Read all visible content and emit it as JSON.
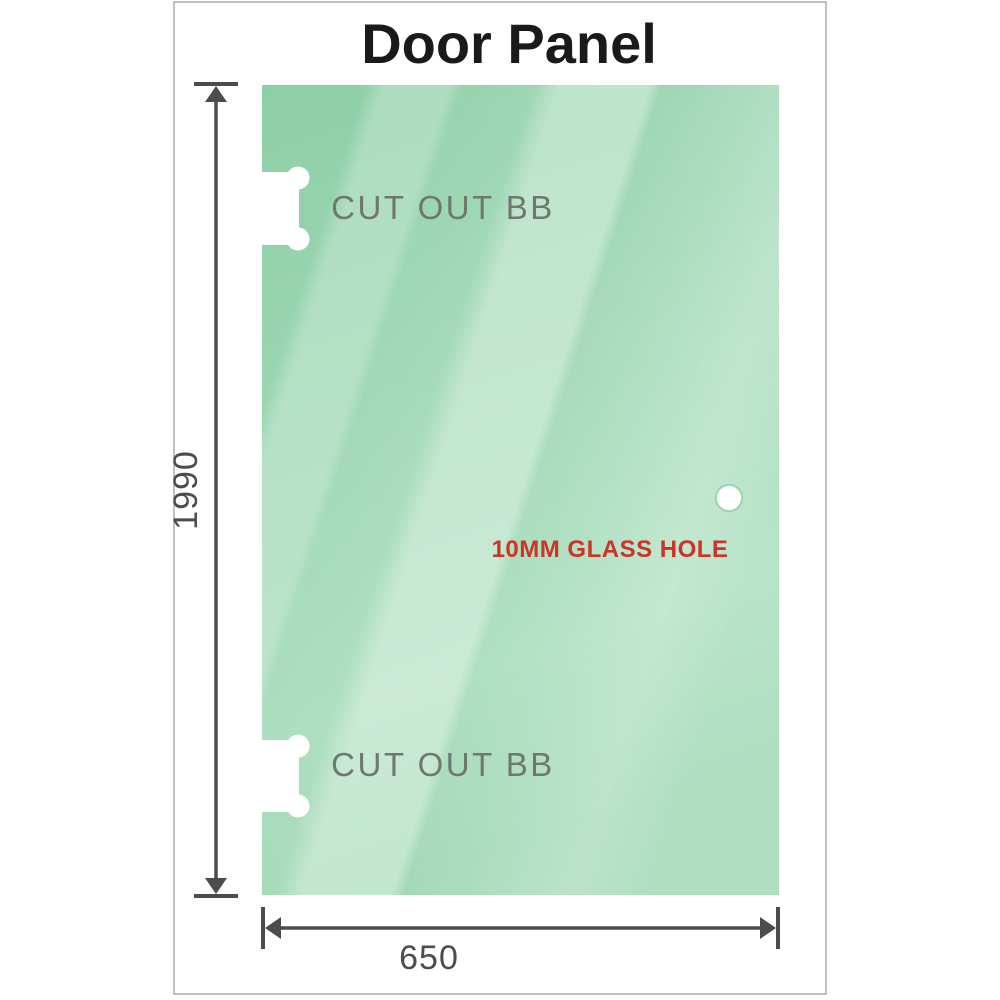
{
  "diagram": {
    "title": "Door Panel",
    "panel": {
      "cutout_top_label": "CUT OUT BB",
      "cutout_bottom_label": "CUT OUT BB",
      "hole_label": "10MM GLASS HOLE"
    },
    "dimensions": {
      "height_value": "1990",
      "width_value": "650"
    },
    "colors": {
      "glass_top": "#8ecfa7",
      "glass_mid": "#9dd7b3",
      "glass_mid2": "#a6dcba",
      "glass_bottom": "#9ad5b0",
      "frame_border": "#ababab",
      "title_color": "#1a1a1a",
      "label_gray": "#6e786f",
      "hole_label_red": "#cc3526",
      "dimension_gray": "#4c4c4c",
      "hole_ring_green": "#7cc49c",
      "hole_fill": "#ffffff",
      "cutout_fill": "#ffffff"
    }
  }
}
